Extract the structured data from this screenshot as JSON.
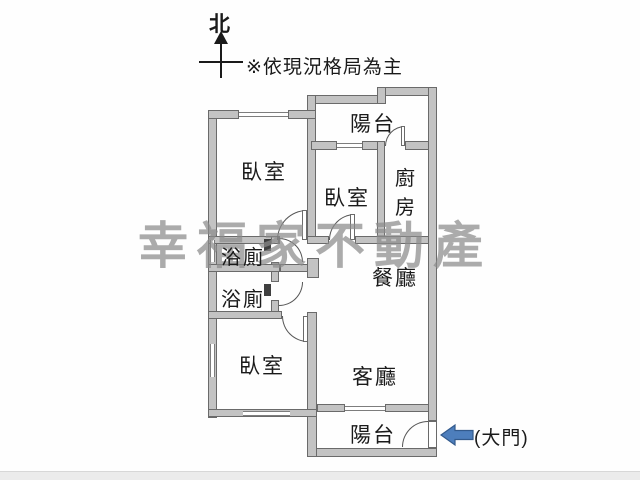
{
  "compass": {
    "north": "北"
  },
  "note": {
    "text": "※依現況格局為主"
  },
  "watermark": {
    "text": "幸福家不動產",
    "color": "#8c8c8c"
  },
  "rooms": {
    "balcony_top": "陽台",
    "bedroom_main": "臥室",
    "bedroom_middle": "臥室",
    "kitchen": "廚房",
    "bath_upper": "浴廁",
    "bath_lower": "浴廁",
    "dining": "餐廳",
    "bedroom_lower": "臥室",
    "living": "客廳",
    "balcony_bottom": "陽台"
  },
  "entrance": {
    "label": "(大門)",
    "arrow_color": "#4d7ebc",
    "arrow_outline": "#335a8c"
  }
}
